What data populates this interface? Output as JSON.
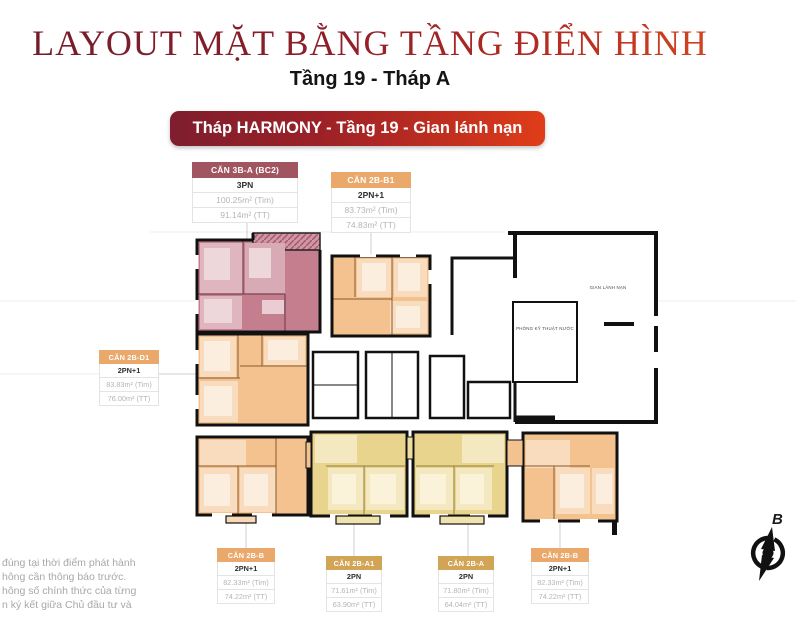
{
  "header": {
    "title": "LAYOUT MẶT BẰNG TẦNG ĐIỂN HÌNH",
    "subtitle": "Tầng 19 - Tháp A",
    "banner": "Tháp HARMONY - Tầng 19 - Gian lánh nạn"
  },
  "unit_cards": [
    {
      "name": "CĂN 3B-A (BC2)",
      "type": "3PN",
      "area_tim": "100.25m² (Tim)",
      "area_tt": "91.14m² (TT)",
      "header_color": "#a05560"
    },
    {
      "name": "CĂN 2B-B1",
      "type": "2PN+1",
      "area_tim": "83.73m² (Tim)",
      "area_tt": "74.83m² (TT)",
      "header_color": "#eaa86b"
    },
    {
      "name": "CĂN 2B-D1",
      "type": "2PN+1",
      "area_tim": "83.83m² (Tim)",
      "area_tt": "76.00m² (TT)",
      "header_color": "#eaa86b"
    },
    {
      "name": "CĂN 2B-B",
      "type": "2PN+1",
      "area_tim": "82.33m² (Tim)",
      "area_tt": "74.22m² (TT)",
      "header_color": "#eaa86b"
    },
    {
      "name": "CĂN 2B-A1",
      "type": "2PN",
      "area_tim": "71.61m² (Tim)",
      "area_tt": "63.90m² (TT)",
      "header_color": "#d2a455"
    },
    {
      "name": "CĂN 2B-A",
      "type": "2PN",
      "area_tim": "71.80m² (Tim)",
      "area_tt": "64.04m² (TT)",
      "header_color": "#d2a455"
    },
    {
      "name": "CĂN 2B-B",
      "type": "2PN+1",
      "area_tim": "82.33m² (Tim)",
      "area_tt": "74.22m² (TT)",
      "header_color": "#eaa86b"
    }
  ],
  "plan_labels": {
    "refuge": "GIAN LÁNH NẠN",
    "water_tech": "PHÒNG KỸ THUẬT NƯỚC"
  },
  "compass": {
    "north_label": "B"
  },
  "disclaimer": {
    "lines": [
      "đúng tại thời điểm phát hành",
      "hông cần thông báo trước.",
      "hông số chính thức của từng",
      "n ký kết giữa Chủ đầu tư và"
    ]
  },
  "colors": {
    "title_dark": "#6f1d2c",
    "title_bright": "#d6491f",
    "banner_left": "#7e1e2e",
    "banner_right": "#e03d19",
    "unit_pink": "#c47e8e",
    "unit_orange": "#f4c28f",
    "unit_yellow": "#e9d48d",
    "wall": "#111111"
  }
}
